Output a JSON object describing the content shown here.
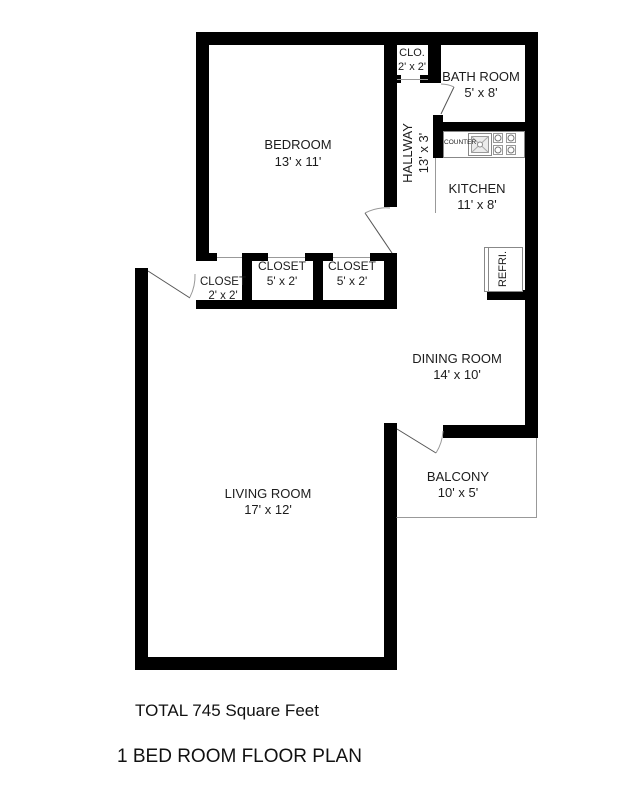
{
  "plan": {
    "title": "1 BED ROOM FLOOR PLAN",
    "total_area": "TOTAL 745 Square Feet"
  },
  "rooms": {
    "bedroom": {
      "name": "BEDROOM",
      "dims": "13' x 11'"
    },
    "closet_top": {
      "name": "CLO.",
      "dims": "2' x 2'"
    },
    "bathroom": {
      "name": "BATH ROOM",
      "dims": "5' x 8'"
    },
    "hallway": {
      "name": "HALLWAY",
      "dims": "13' x 3'"
    },
    "kitchen": {
      "name": "KITCHEN",
      "dims": "11' x 8'"
    },
    "closet_1": {
      "name": "CLOSET",
      "dims": "2' x 2'"
    },
    "closet_2": {
      "name": "CLOSET",
      "dims": "5' x 2'"
    },
    "closet_3": {
      "name": "CLOSET",
      "dims": "5' x 2'"
    },
    "dining_room": {
      "name": "DINING ROOM",
      "dims": "14' x 10'"
    },
    "living_room": {
      "name": "LIVING ROOM",
      "dims": "17' x 12'"
    },
    "balcony": {
      "name": "BALCONY",
      "dims": "10' x 5'"
    }
  },
  "fixtures": {
    "counter": "COUNTER",
    "refrigerator": "REFRI."
  },
  "colors": {
    "wall": "#000000",
    "fixture_line": "#888888",
    "door_line": "#666666",
    "text": "#1c1c1c",
    "background": "#ffffff"
  }
}
